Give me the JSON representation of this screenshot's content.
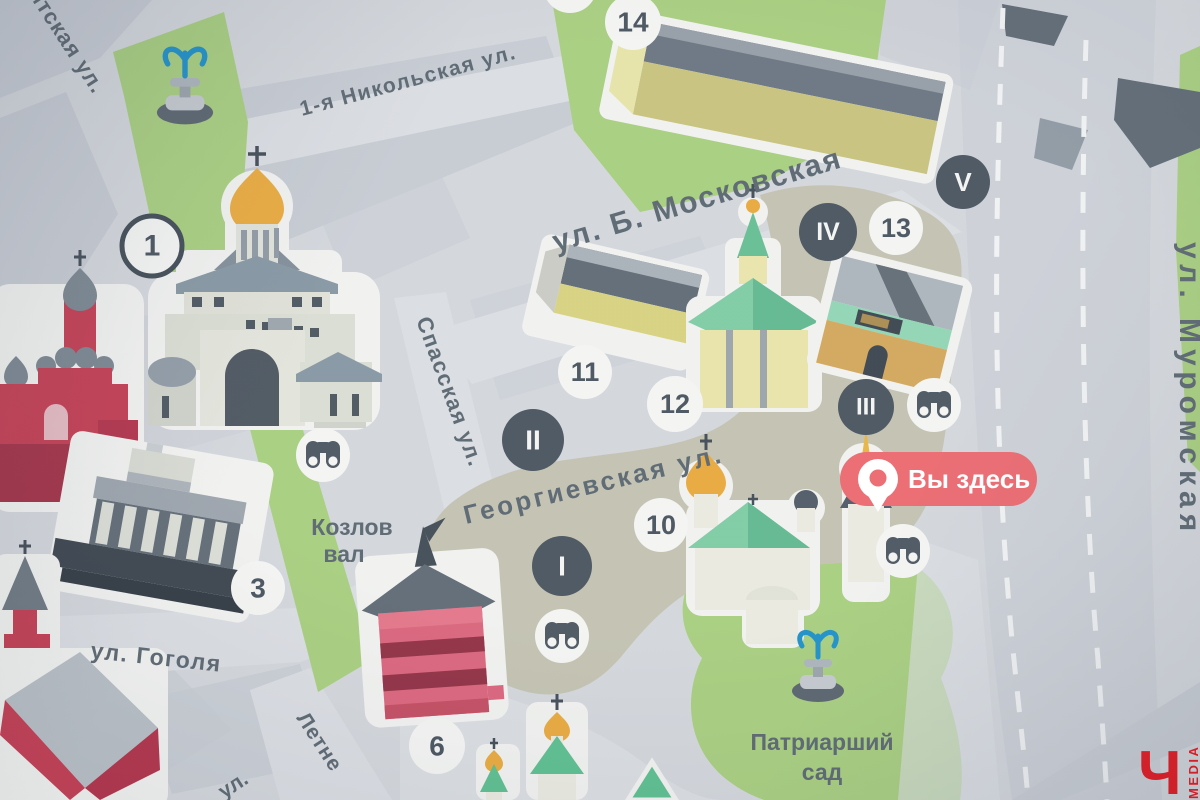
{
  "map": {
    "kind": "printed tourist street map (photo)"
  },
  "streets": {
    "nikitskaya_partial": "итская ул.",
    "nikolskaya": "1-я Никольская ул.",
    "bolshaya_moskovskaya": "ул. Б. Московская",
    "spasskaya": "Спасская ул.",
    "georgievskaya": "Георгиевская ул.",
    "gogolya": "ул. Гоголя",
    "muromskaya": "ул. Муромская",
    "letnyaya_partial": "Летне",
    "ul_partial": "ул.",
    "kozlov_val": {
      "line1": "Козлов",
      "line2": "вал"
    },
    "patriarshiy_sad": {
      "line1": "Патриарший",
      "line2": "сад"
    }
  },
  "markers": {
    "numbered": [
      {
        "label": "1"
      },
      {
        "label": "3"
      },
      {
        "label": "6"
      },
      {
        "label": "10"
      },
      {
        "label": "11"
      },
      {
        "label": "12"
      },
      {
        "label": "13"
      },
      {
        "label": "14"
      }
    ],
    "roman": [
      {
        "label": "I"
      },
      {
        "label": "II"
      },
      {
        "label": "III"
      },
      {
        "label": "IV"
      },
      {
        "label": "V"
      }
    ]
  },
  "you_are_here": {
    "label": "Вы здесь",
    "pill_color": "#EA676E"
  },
  "watermark": {
    "letter": "Ч",
    "text": "MEDIA",
    "color": "#E3141C"
  },
  "icons": {
    "binoculars": "viewpoint-binoculars",
    "fountain": "fountain",
    "location_pin": "you-are-here-pin"
  },
  "colors": {
    "map_background": "#D2D6DB",
    "city_block": "#C5CAD2",
    "road_band": "#CBCFD6",
    "park_green": "#A6CD7D",
    "pedestrian_tan": "#C2C1B0",
    "marker_dark": "#47525D",
    "marker_light": "#F3F4F2",
    "street_text": "#59656F",
    "gold_dome": "#E8A83B",
    "brick_red": "#C23A50",
    "tower_pink": "#D9627A",
    "roof_slate": "#5D6873"
  }
}
